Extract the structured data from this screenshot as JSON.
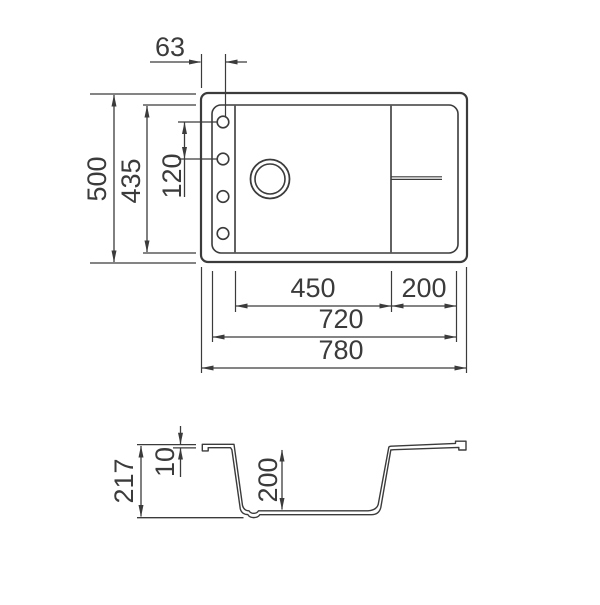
{
  "drawing": {
    "title": "sink-technical-drawing",
    "line_color": "#3b3b3b",
    "background_color": "#ffffff",
    "top_view": {
      "features": {
        "tap_holes": 4,
        "drain_rings": 2,
        "sections": [
          "tap-ledge",
          "bowl",
          "drainboard"
        ]
      },
      "dims": {
        "hole_offset": "63",
        "overall_depth": "500",
        "inner_depth": "435",
        "hole_spacing": "120",
        "bowl_width": "450",
        "drainer_width": "200",
        "inner_width": "720",
        "overall_width": "780"
      }
    },
    "side_view": {
      "dims": {
        "overall_height": "217",
        "rim_thickness": "10",
        "bowl_depth": "200"
      }
    }
  }
}
